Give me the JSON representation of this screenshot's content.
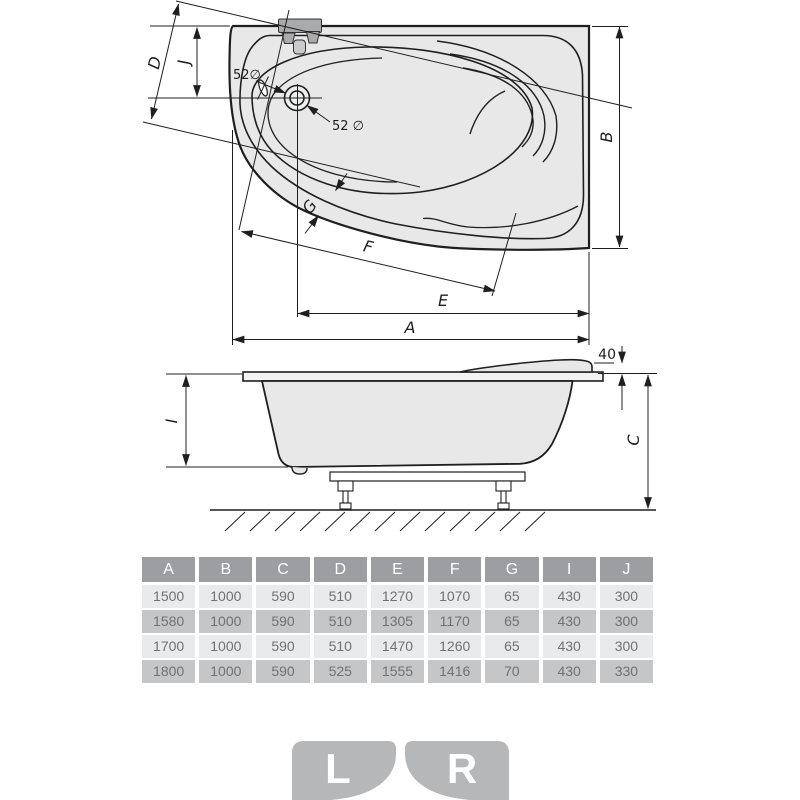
{
  "plan_view": {
    "dim_a": "A",
    "dim_b": "B",
    "dim_d": "D",
    "dim_e": "E",
    "dim_f": "F",
    "dim_g": "G",
    "dim_j": "J",
    "overflow_label": "52∅",
    "drain_label": "52 ∅"
  },
  "side_view": {
    "dim_i": "I",
    "dim_c": "C",
    "headrest_height": "40"
  },
  "table": {
    "headers": [
      "A",
      "B",
      "C",
      "D",
      "E",
      "F",
      "G",
      "I",
      "J"
    ],
    "rows": [
      [
        "1500",
        "1000",
        "590",
        "510",
        "1270",
        "1070",
        "65",
        "430",
        "300"
      ],
      [
        "1580",
        "1000",
        "590",
        "510",
        "1305",
        "1170",
        "65",
        "430",
        "300"
      ],
      [
        "1700",
        "1000",
        "590",
        "510",
        "1470",
        "1260",
        "65",
        "430",
        "300"
      ],
      [
        "1800",
        "1000",
        "590",
        "525",
        "1555",
        "1416",
        "70",
        "430",
        "330"
      ]
    ]
  },
  "orientation": {
    "left": "L",
    "right": "R"
  },
  "colors": {
    "line": "#1f1f1f",
    "tub_fill": "#e8e8e9",
    "faucet_fill": "#a8aaac",
    "table_header_bg": "#9c9ea1",
    "table_header_text": "#ffffff",
    "row_light_bg": "#e9eaeb",
    "row_dark_bg": "#c5c6c8",
    "cell_text": "#6f7174",
    "icon_bg": "#b6b7b9",
    "icon_letter": "#ffffff"
  }
}
